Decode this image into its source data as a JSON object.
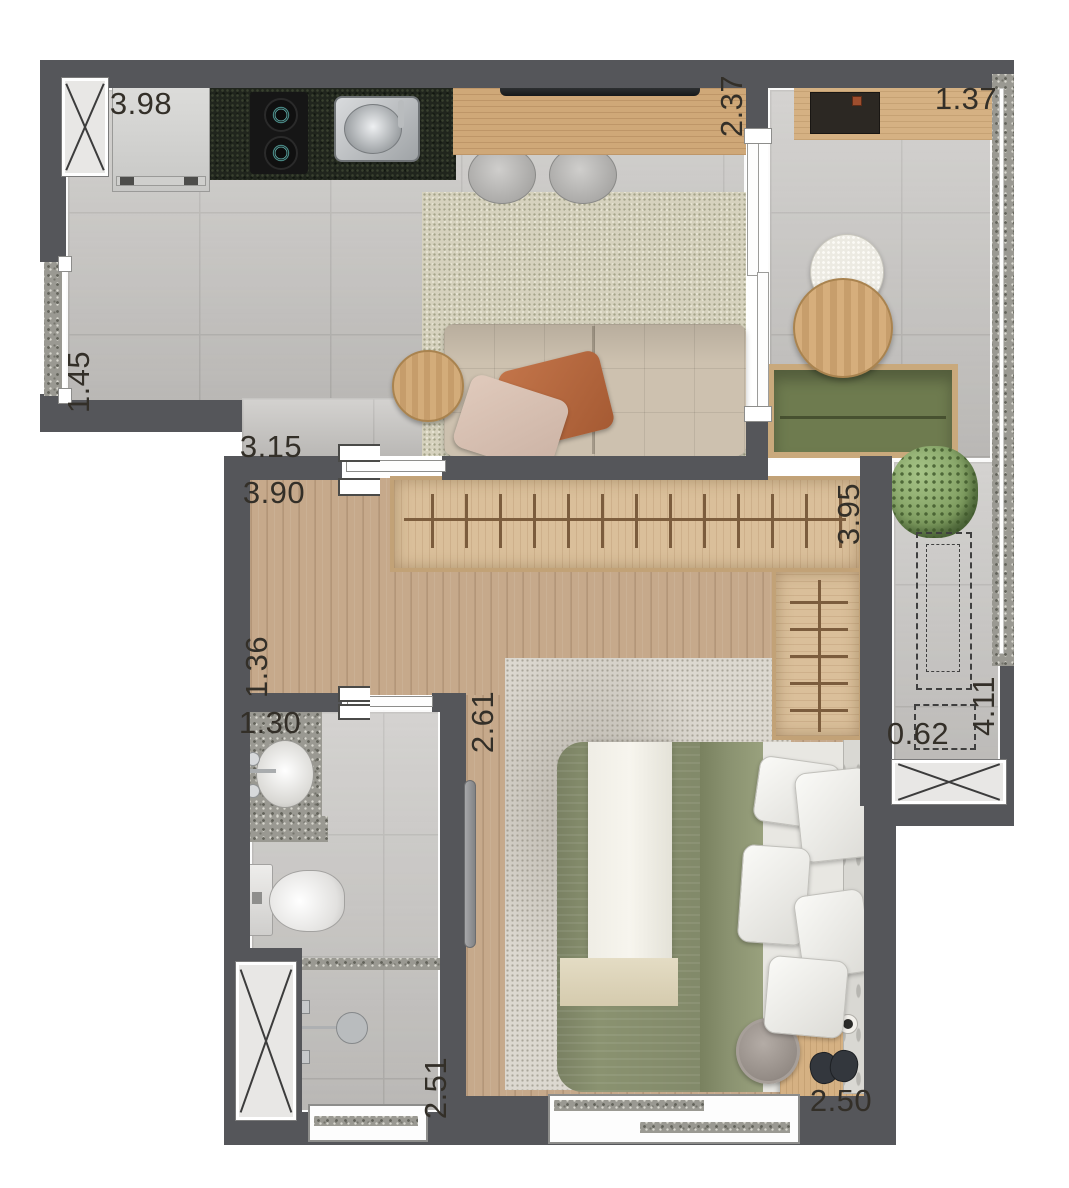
{
  "dimensions": [
    {
      "id": "kitchen-run-width",
      "value": "3.98",
      "orientation": "horizontal"
    },
    {
      "id": "living-balcony-opening",
      "value": "2.37",
      "orientation": "vertical"
    },
    {
      "id": "balcony-bar-width",
      "value": "1.37",
      "orientation": "horizontal"
    },
    {
      "id": "entry-width",
      "value": "1.45",
      "orientation": "vertical"
    },
    {
      "id": "living-room-width",
      "value": "3.15",
      "orientation": "horizontal"
    },
    {
      "id": "closet-room-width",
      "value": "3.90",
      "orientation": "horizontal"
    },
    {
      "id": "closet-room-depth",
      "value": "3.95",
      "orientation": "vertical"
    },
    {
      "id": "hall-width",
      "value": "1.36",
      "orientation": "vertical"
    },
    {
      "id": "vanity-width",
      "value": "1.30",
      "orientation": "horizontal"
    },
    {
      "id": "bedroom-opening",
      "value": "2.61",
      "orientation": "vertical"
    },
    {
      "id": "tech-ledge-width",
      "value": "0.62",
      "orientation": "horizontal"
    },
    {
      "id": "balcony-length",
      "value": "4.11",
      "orientation": "vertical"
    },
    {
      "id": "shower-room-length",
      "value": "2.51",
      "orientation": "vertical"
    },
    {
      "id": "bedroom-width",
      "value": "2.50",
      "orientation": "horizontal"
    }
  ],
  "rooms": [
    "kitchen",
    "living-room",
    "balcony",
    "walk-in-closet",
    "hall",
    "bathroom",
    "bedroom",
    "technical-ledge"
  ],
  "furniture": [
    "refrigerator",
    "cooktop",
    "kitchen-sink",
    "granite-counter",
    "tv",
    "tv-sideboard",
    "counter-stools",
    "living-rug",
    "sofa",
    "throw-pillows",
    "side-table",
    "coffee-bar-shelf",
    "lounge-chair",
    "round-table",
    "garden-bench",
    "potted-plant",
    "ac-condenser-outline",
    "wardrobe-with-hangers",
    "vanity-sink",
    "toilet",
    "shower-head",
    "bed",
    "bed-pillows",
    "headboard",
    "bedroom-rug",
    "desk",
    "pouf",
    "cups",
    "slippers",
    "ventilation-shafts",
    "sliding-doors",
    "windows"
  ],
  "colors": {
    "wall": "#55565a",
    "tile_floor": "#c8c6c3",
    "wood_floor": "#c6a98b",
    "wardrobe_wood": "#dabf9a",
    "counter_granite": "#20251d",
    "terrazzo": "#9a9992",
    "sofa": "#cdc1af",
    "terracotta_pillow": "#b7683e",
    "bench_green": "#6e7b4f",
    "duvet_green": "#8a9270",
    "living_rug": "#d6d2be",
    "bedroom_rug": "#dcd8d0"
  }
}
